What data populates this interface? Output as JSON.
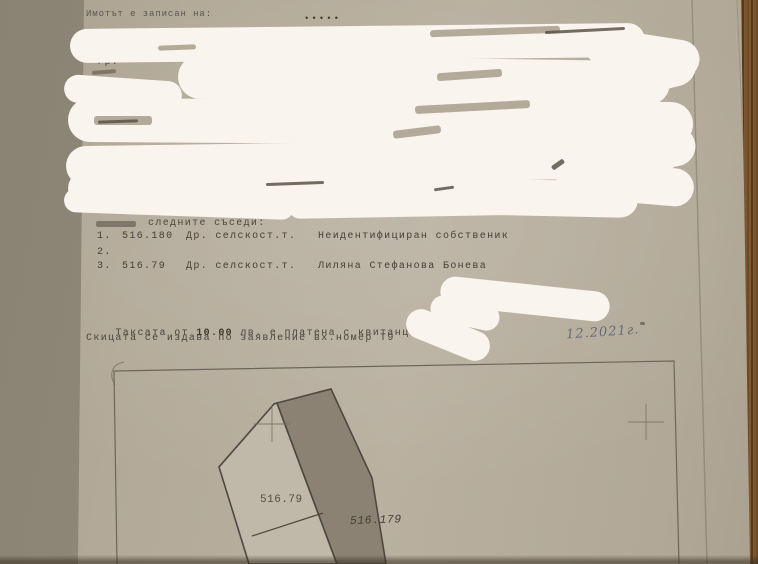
{
  "document": {
    "registered_line": "Имотът е записан на:",
    "dots": "•••••",
    "city_fragment": "– гр.",
    "neighbors": {
      "header_visible": "следните съседи:",
      "rows": [
        {
          "num": "1.",
          "parcel": "516.180",
          "type": "Др. селскост.т.",
          "owner": "Неидентифициран собственик"
        },
        {
          "num": "2.",
          "parcel": "",
          "type": "",
          "owner": ""
        },
        {
          "num": "3.",
          "parcel": "516.79",
          "type": "Др. селскост.т.",
          "owner": "Лиляна Стефанова Бонева"
        }
      ]
    },
    "fee_line": {
      "prefix": "Таксата от",
      "amount": "10.00",
      "middle": "лв. е платена с квитанция",
      "number_sign": "№",
      "number_fragment": "3"
    },
    "application_line": "Скицата се издава по заявление вх.номер Т9",
    "handwritten_date": "12.2021г."
  },
  "map": {
    "parcel_left_label": "516.79",
    "parcel_right_label": "516.179"
  },
  "colors": {
    "paper": "#b6ad9c",
    "table_background": "#8f8879",
    "wood_edge": "#6d4c28",
    "redaction_white": "#f9f5ee",
    "typewriter_ink": "#4a443b",
    "handwriting_ink": "#666c78",
    "parcel_dark_fill": "#8b8274",
    "parcel_light_fill": "#c0b8a8"
  }
}
